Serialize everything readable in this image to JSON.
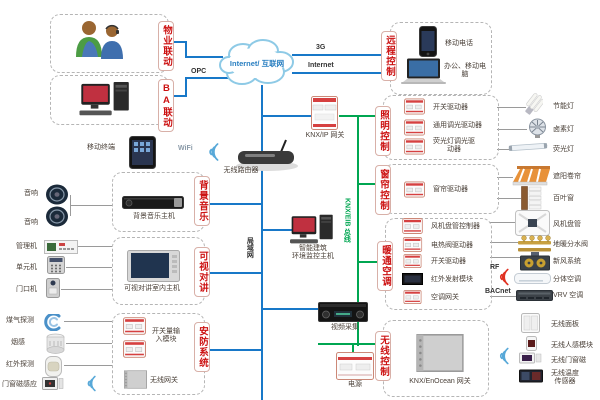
{
  "colors": {
    "blue_line": "#1878c8",
    "green_line": "#00a651",
    "label_red": "#cc1111"
  },
  "property": {
    "label": "物业联动"
  },
  "ba": {
    "label": "BA联动"
  },
  "music": {
    "label": "背景音乐",
    "host": "背景音乐主机",
    "speaker1": "音响",
    "speaker2": "音响"
  },
  "intercom": {
    "label": "可视对讲",
    "host": "可视对讲室内主机",
    "devices": [
      "管理机",
      "单元机",
      "门口机"
    ]
  },
  "security": {
    "label": "安防系统",
    "module": "开关量输入模块",
    "gateway": "无线网关",
    "sensors": [
      "煤气探测",
      "烟感",
      "红外探测",
      "门窗磁感应"
    ]
  },
  "remote": {
    "label": "远程控制",
    "phone": "移动电话",
    "laptop": "办公、移动电脑"
  },
  "lighting": {
    "label": "照明控制",
    "drivers": [
      "开关驱动器",
      "通用调光驱动器",
      "荧光灯调光驱动器"
    ],
    "loads": [
      "节能灯",
      "卤素灯",
      "荧光灯"
    ]
  },
  "curtain": {
    "label": "窗帘控制",
    "driver": "窗帘驱动器",
    "loads": [
      "遮阳卷帘",
      "百叶窗"
    ]
  },
  "hvac": {
    "label": "暖通空调",
    "drivers": [
      "风机盘管控制器",
      "电热阀驱动器",
      "开关驱动器",
      "红外发射模块",
      "空调网关"
    ],
    "loads": [
      "风机盘管",
      "地暖分水阀",
      "新风系统",
      "分体空调",
      "VRV 空调"
    ]
  },
  "wireless": {
    "label": "无线控制",
    "gateway": "KNX/EnOcean 网关",
    "devices": [
      "无线面板",
      "无线人感模块",
      "无线门窗磁",
      "无线温度传感器"
    ]
  },
  "net": {
    "cloud": "Internet/ 互联网",
    "g3": "3G",
    "internet": "Internet",
    "opc": "OPC",
    "wifi": "WiFi",
    "rf": "RF",
    "bacnet": "BACnet",
    "lan": "局域网",
    "knx_bus": "KNX/EIB 总线"
  },
  "center": {
    "terminal": "移动终端",
    "router": "无线路由器",
    "knx_ip": "KNX/IP 网关",
    "host1": "智能建筑",
    "host2": "环境监控主机",
    "video": "视频采集",
    "power": "电源"
  }
}
